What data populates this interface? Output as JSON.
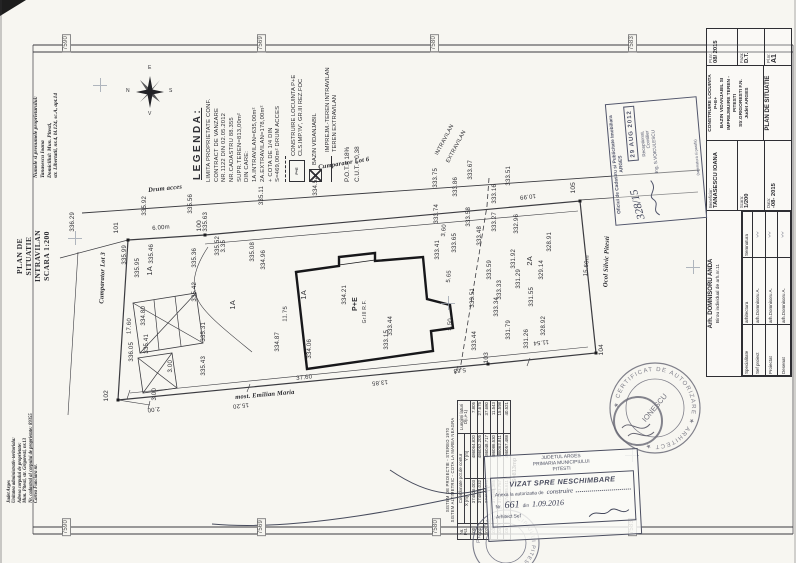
{
  "doc": {
    "owner_lines": [
      "Numele si prenumele proprietarului:",
      "Tanasescu Ioana",
      "Domiciliul: Mun. Pitesti,",
      "str. Libertatii, nr.4, bl.124, sc.A, apt.14"
    ],
    "plan_title_lines": [
      "PLAN DE SITUATIE",
      "INTRAVILAN",
      "SCARA 1:200"
    ],
    "admin_lines": [
      "Judet Arges",
      "Unitatea administrativ-teritoriala:",
      "Adresa corpului de proprietate:",
      "Mun. Pitesti, str. Grigoresti, nr.13",
      "Nr. cadastral al corpului de proprietate: 89355",
      "Cartea Funciara nr."
    ],
    "fold_marks": [
      {
        "t": "7590",
        "x": 62,
        "y": 34,
        "c": "fold"
      },
      {
        "t": "7569",
        "x": 257,
        "y": 34,
        "c": "fold"
      },
      {
        "t": "7580",
        "x": 430,
        "y": 34,
        "c": "fold"
      },
      {
        "t": "7583",
        "x": 628,
        "y": 34,
        "c": "fold"
      },
      {
        "t": "7590",
        "x": 62,
        "y": 518,
        "c": "fold"
      },
      {
        "t": "7569",
        "x": 257,
        "y": 518,
        "c": "fold"
      },
      {
        "t": "7580",
        "x": 432,
        "y": 518,
        "c": "fold"
      },
      {
        "t": "7583",
        "x": 628,
        "y": 518,
        "c": "fold"
      }
    ]
  },
  "compass": {
    "e": "E",
    "n": "N",
    "s": "S",
    "v": "V"
  },
  "legend": {
    "title": "LEGENDA:",
    "lines": [
      "LIMITA PROPRIETATE CONF.",
      "CONTRACT DE VANZARE",
      "NR.1122 DIN 02.05.2012",
      "NR.CADASTRU 88.355",
      "SUPR.TEREN=813,00m²",
      "DIN CARE:",
      "1A.INTRAVILAN=635,00m²",
      "2A.EXTRAVILAN=178,00m²",
      "+ COTA DE 1/4 DIN",
      "S=469,00m² DRUM ACCES"
    ],
    "items": [
      {
        "sym": "limit",
        "tag": "",
        "l1": "",
        "l2": ""
      },
      {
        "sym": "house",
        "tag": "P+E",
        "l1": "CONSTRUIRE LOCUINTA P+E",
        "l2": "CLS.IMP.'IV', GR.III REZ.FOC"
      },
      {
        "sym": "hatch",
        "tag": "",
        "l1": "BAZIN VIDANJABIL",
        "l2": ""
      },
      {
        "sym": "fence",
        "tag": "",
        "l1": "IMPREJM.-TEREN INTRAVILAN",
        "l2": "TEREN EXTRAVILAN"
      }
    ],
    "pot": "P.O.T.= 18%",
    "cut": "C.U.T.= 0,38"
  },
  "plan": {
    "labels": [
      {
        "t": "336.29",
        "x": 70,
        "y": 212
      },
      {
        "t": "335.92",
        "x": 142,
        "y": 196
      },
      {
        "t": "335.56",
        "x": 188,
        "y": 194
      },
      {
        "t": "335.63",
        "x": 203,
        "y": 212
      },
      {
        "t": "335.99",
        "x": 122,
        "y": 245
      },
      {
        "t": "335.95",
        "x": 135,
        "y": 258
      },
      {
        "t": "335.46",
        "x": 149,
        "y": 244
      },
      {
        "t": "335.36",
        "x": 192,
        "y": 248
      },
      {
        "t": "335.52",
        "x": 215,
        "y": 236
      },
      {
        "t": "335.08",
        "x": 250,
        "y": 242
      },
      {
        "t": "334.96",
        "x": 261,
        "y": 250
      },
      {
        "t": "335.11",
        "x": 259,
        "y": 186
      },
      {
        "t": "334.52",
        "x": 313,
        "y": 176
      },
      {
        "t": "335.42",
        "x": 192,
        "y": 282
      },
      {
        "t": "334.80",
        "x": 141,
        "y": 306
      },
      {
        "t": "335.31",
        "x": 201,
        "y": 322
      },
      {
        "t": "336.05",
        "x": 129,
        "y": 342
      },
      {
        "t": "335.41",
        "x": 144,
        "y": 334
      },
      {
        "t": "335.43",
        "x": 201,
        "y": 356
      },
      {
        "t": "334.87",
        "x": 275,
        "y": 332
      },
      {
        "t": "333.75",
        "x": 433,
        "y": 168
      },
      {
        "t": "333.86",
        "x": 453,
        "y": 177
      },
      {
        "t": "333.67",
        "x": 468,
        "y": 160
      },
      {
        "t": "333.51",
        "x": 506,
        "y": 166
      },
      {
        "t": "333.16",
        "x": 492,
        "y": 184
      },
      {
        "t": "333.74",
        "x": 434,
        "y": 204
      },
      {
        "t": "333.58",
        "x": 466,
        "y": 207
      },
      {
        "t": "333.27",
        "x": 492,
        "y": 212
      },
      {
        "t": "332.96",
        "x": 514,
        "y": 214
      },
      {
        "t": "333.48",
        "x": 477,
        "y": 226
      },
      {
        "t": "333.65",
        "x": 452,
        "y": 233
      },
      {
        "t": "333.41",
        "x": 435,
        "y": 240
      },
      {
        "t": "333.59",
        "x": 487,
        "y": 260
      },
      {
        "t": "333.33",
        "x": 497,
        "y": 280
      },
      {
        "t": "331.92",
        "x": 511,
        "y": 249
      },
      {
        "t": "331.29",
        "x": 516,
        "y": 269
      },
      {
        "t": "329.14",
        "x": 539,
        "y": 260
      },
      {
        "t": "328.91",
        "x": 547,
        "y": 232
      },
      {
        "t": "331.55",
        "x": 529,
        "y": 287
      },
      {
        "t": "331.26",
        "x": 524,
        "y": 329
      },
      {
        "t": "328.92",
        "x": 541,
        "y": 316
      },
      {
        "t": "331.79",
        "x": 506,
        "y": 320
      },
      {
        "t": "333.44",
        "x": 472,
        "y": 331
      },
      {
        "t": "333.34",
        "x": 494,
        "y": 297
      },
      {
        "t": "333.44",
        "x": 388,
        "y": 316
      },
      {
        "t": "333.15",
        "x": 384,
        "y": 330
      },
      {
        "t": "334.21",
        "x": 342,
        "y": 285
      },
      {
        "t": "334.06",
        "x": 307,
        "y": 339
      },
      {
        "t": "333.51",
        "x": 470,
        "y": 288
      },
      {
        "t": "100",
        "x": 197,
        "y": 220,
        "s": 6.5
      },
      {
        "t": "101",
        "x": 114,
        "y": 222,
        "s": 6.5
      },
      {
        "t": "102",
        "x": 104,
        "y": 390,
        "s": 6.5
      },
      {
        "t": "103",
        "x": 484,
        "y": 352,
        "s": 6.5
      },
      {
        "t": "104",
        "x": 599,
        "y": 344,
        "s": 6.5
      },
      {
        "t": "105",
        "x": 571,
        "y": 182,
        "s": 6.5
      },
      {
        "t": "6.00m",
        "x": 152,
        "y": 226,
        "r": -5
      },
      {
        "t": "3.35",
        "x": 221,
        "y": 240
      },
      {
        "t": "10.99",
        "x": 536,
        "y": 198,
        "r": 174
      },
      {
        "t": "15.60m",
        "x": 585,
        "y": 255,
        "r": -85
      },
      {
        "t": "11.54",
        "x": 549,
        "y": 344,
        "r": 174
      },
      {
        "t": "5.63",
        "x": 466,
        "y": 372,
        "r": 174
      },
      {
        "t": "13.85",
        "x": 388,
        "y": 384,
        "r": 174
      },
      {
        "t": "37.60",
        "x": 296,
        "y": 376,
        "r": -6
      },
      {
        "t": "15.20",
        "x": 249,
        "y": 407,
        "r": 174
      },
      {
        "t": "2.00",
        "x": 160,
        "y": 411,
        "r": 174
      },
      {
        "t": "17.60",
        "x": 127,
        "y": 318,
        "r": -88
      },
      {
        "t": "11.75",
        "x": 283,
        "y": 306,
        "r": -88
      },
      {
        "t": "5.65",
        "x": 447,
        "y": 270,
        "r": -85
      },
      {
        "t": "5.50",
        "x": 448,
        "y": 318,
        "r": -85
      },
      {
        "t": "3.60",
        "x": 442,
        "y": 224,
        "r": -85
      },
      {
        "t": "3.00",
        "x": 168,
        "y": 360
      },
      {
        "t": "3.00",
        "x": 152,
        "y": 388
      },
      {
        "t": "1A",
        "x": 146,
        "y": 266,
        "s": 7.5
      },
      {
        "t": "1A",
        "x": 229,
        "y": 300,
        "s": 7.5
      },
      {
        "t": "1A",
        "x": 300,
        "y": 290,
        "s": 7.5
      },
      {
        "t": "2A",
        "x": 526,
        "y": 256,
        "s": 7.5
      },
      {
        "t": "P+E",
        "x": 352,
        "y": 297,
        "s": 7,
        "w": 1
      },
      {
        "t": "Gr.III R.F.",
        "x": 363,
        "y": 300,
        "s": 5
      },
      {
        "t": "INTRAVILAN",
        "x": 451,
        "y": 124,
        "r": -62,
        "s": 5.5
      },
      {
        "t": "EXTRAVILAN",
        "x": 463,
        "y": 130,
        "r": -62,
        "s": 5.5
      },
      {
        "t": "Drum acces",
        "x": 148,
        "y": 188,
        "r": -6,
        "c": "nb",
        "s": 6.5
      },
      {
        "t": "Cumparator Lot 6",
        "x": 318,
        "y": 165,
        "r": -9,
        "c": "nb",
        "s": 6.5
      },
      {
        "t": "Cumparator Lot 3",
        "x": 101,
        "y": 252,
        "r": -88,
        "c": "nb",
        "s": 6.5
      },
      {
        "t": "most. Emilian Maria",
        "x": 235,
        "y": 395,
        "r": -5,
        "c": "nb",
        "s": 6.5
      },
      {
        "t": "Ocol Silvic Pitesti",
        "x": 605,
        "y": 236,
        "r": -88,
        "c": "nb",
        "s": 6.5
      }
    ],
    "crosses": [
      {
        "x": 100,
        "y": 85
      },
      {
        "x": 75,
        "y": 238
      },
      {
        "x": 448,
        "y": 303
      },
      {
        "x": 693,
        "y": 267
      },
      {
        "x": 632,
        "y": 455
      }
    ]
  },
  "coord_table": {
    "header1": "SISTEM DE PROIECTIE - STEREO 1970",
    "header2": "SISTEM ALTIMETRIC - COTA LA MAREA NEAGRA",
    "col_nr": "Nr. Pct.",
    "col_coord": "Coordonate pct.de contur",
    "col_x": "X [m]",
    "col_y": "Y [m]",
    "col_len": "Lungimi laturi D(i,i+1)",
    "rows": [
      [
        "100",
        "374826.003",
        "486064.820",
        "7.805"
      ],
      [
        "101",
        "374824.032",
        "486052.205",
        "27.675"
      ],
      [
        "102",
        "374853.575",
        "486048.717",
        "37.680"
      ],
      [
        "103",
        "374985.365",
        "486086.530",
        "11.543"
      ],
      [
        "104",
        "374983.757",
        "486062.811",
        "15.598"
      ],
      [
        "105",
        "374985.611",
        "486057.488",
        "40.521"
      ]
    ],
    "footer": "S=813mp"
  },
  "titleblock": {
    "designer1": "Arh. DOMNISORU ANDA",
    "designer2": "Birou individual de arh.nr.11",
    "spec_h1": "Specialitate",
    "spec_h2": "arhitectura",
    "spec_h3": "Semnatura",
    "roles": [
      [
        "Sef proiect",
        "arh.Domnisoru A."
      ],
      [
        "Proiectat",
        "arh.Domnisoru A."
      ],
      [
        "Desenat",
        "arh.Domnisoru A."
      ]
    ],
    "beneficiar_label": "Beneficiar:",
    "beneficiar": "TANASESCU IOANA",
    "scara_label": "Scara:",
    "scara": "1/200",
    "data_label": "Data:",
    "data": "-08- 2015",
    "project_lines": [
      "CONSTRUIRE LOCUINTA P+E+",
      "BAZIN VIDANJABIL SI",
      "IMPREJMUIRE TEREN - PITESTI",
      "Str.GRIGORESTI F.N.",
      "Judet ARGES"
    ],
    "plansa": "PLAN DE SITUATIE",
    "pr_label": "Pr.nr.",
    "pr": "08/ 2015",
    "faza_label": "Faza:",
    "faza": "D.T.",
    "pl_label": "Pl.nr.",
    "pl": "A1"
  },
  "stamps": {
    "ocpi": {
      "name1": "Oficiul de Cadastru si Publicitate Imobiliara",
      "name2": "ARGES",
      "number": "328/15",
      "date": "29 AUG 2012",
      "rec1": "Receptionat,",
      "rec2": "Consilier",
      "rec3": "Ing. S.VOICULESCU",
      "foot": "(semnatura si parafa)"
    },
    "vizat": {
      "h1": "JUDETUL ARGES",
      "h2": "PRIMARIA MUNICIPIULUI",
      "h3": "PITESTI",
      "title": "VIZAT SPRE NESCHIMBARE",
      "anexa": "Anexa la autorizatia de",
      "anexa_hw": "construire",
      "nr_label": "Nr.",
      "nr": "661",
      "din": "din",
      "date": "1.09.2016",
      "sign": "Arhitect Sef"
    },
    "round": {
      "ring": "★ CERTIFICAT DE AUTORIZARE ★ ARHITECT ★",
      "center": "IONESCU"
    },
    "round2": {
      "ring": "PRIMARIA MUNICIPIULUI PITESTI ★"
    }
  }
}
